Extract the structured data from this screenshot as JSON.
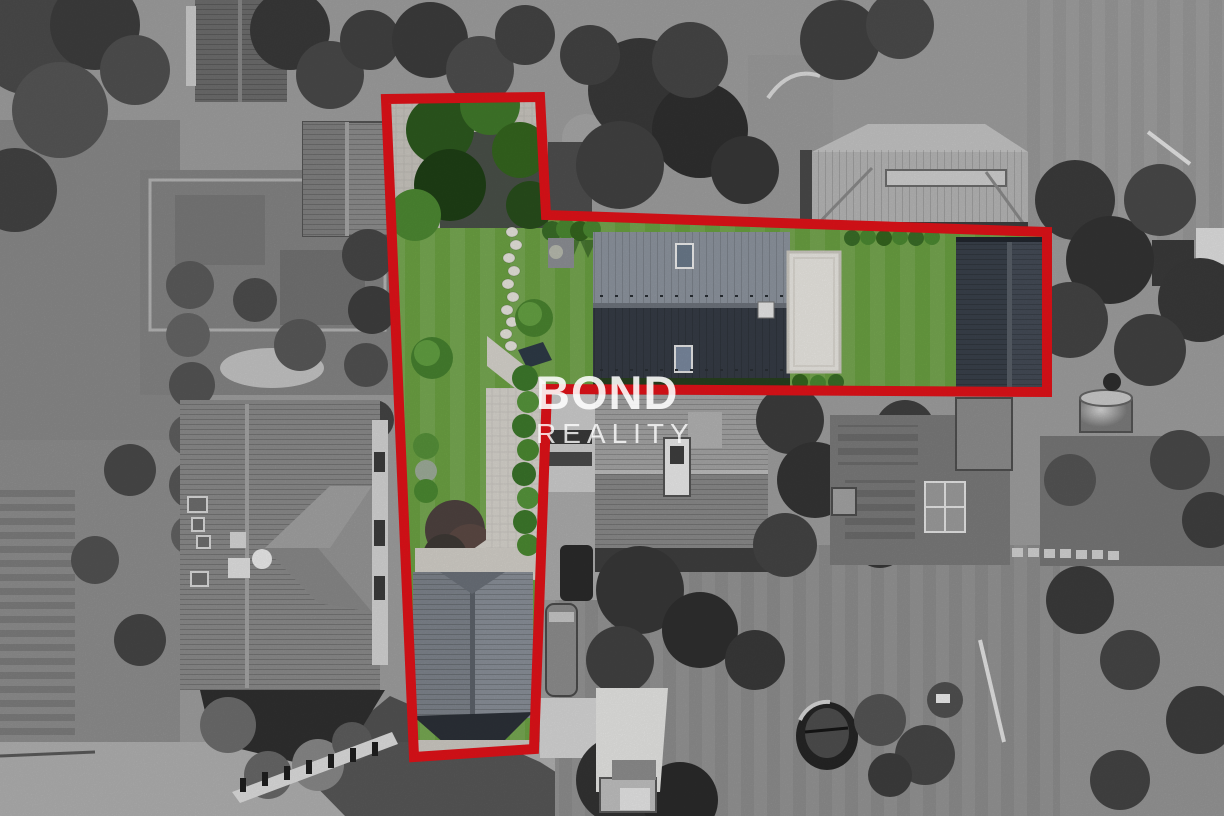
{
  "watermark": {
    "line1": "BOND",
    "line2": "REALITY",
    "color": "#ffffff"
  },
  "overlay": {
    "outline_color": "#e31219",
    "outline_width": 10,
    "polygon_points": "386,99 540,97 546,215 1047,232 1047,392 547,389 534,749 414,757"
  },
  "palette": {
    "highlight_red": "#e31219",
    "lawn_green": "#6da344",
    "hedge_green": "#3f6b2c",
    "main_roof_light_slope": "#8f96a0",
    "main_roof_dark_slope": "#363c46",
    "flat_roof_white": "#eceae5",
    "paving_light": "#d9d6cf",
    "grayscale_base": "#a3a3a3",
    "watermark_white": "#ffffff"
  }
}
